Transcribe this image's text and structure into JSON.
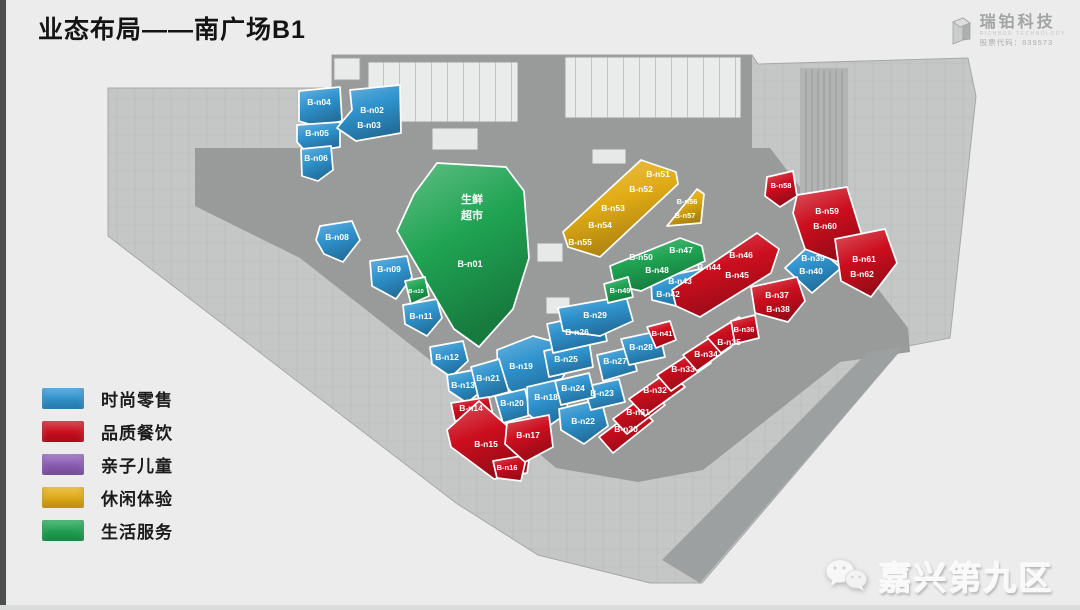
{
  "slide": {
    "title": "业态布局——南广场B1",
    "logo": {
      "name": "瑞铂科技",
      "subtitle": "RICHBOR TECHNOLOGY",
      "stock": "股票代码：839573"
    },
    "watermark": "嘉兴第九区"
  },
  "legend": [
    {
      "key": "retail",
      "label": "时尚零售",
      "color": "#2F93CE"
    },
    {
      "key": "dining",
      "label": "品质餐饮",
      "color": "#CC0E1E"
    },
    {
      "key": "kids",
      "label": "亲子儿童",
      "color": "#8B5CB6"
    },
    {
      "key": "leisure",
      "label": "休闲体验",
      "color": "#E2AC15"
    },
    {
      "key": "life",
      "label": "生活服务",
      "color": "#1FA352"
    }
  ],
  "floorplan": {
    "category_colors": {
      "retail": "#2F93CE",
      "dining": "#CC0E1E",
      "kids": "#8B5CB6",
      "leisure": "#E2AC15",
      "life": "#1FA352"
    },
    "units": [
      {
        "id": "B-n04",
        "category": "retail",
        "points": "299,91 340,87 342,121 318,127 299,121",
        "labels": [
          {
            "t": "B-n04",
            "x": 319,
            "y": 105
          }
        ]
      },
      {
        "id": "B-n05",
        "category": "retail",
        "points": "297,125 340,122 340,147 306,152 297,142",
        "labels": [
          {
            "t": "B-n05",
            "x": 317,
            "y": 136
          }
        ]
      },
      {
        "id": "B-n02-03",
        "category": "retail",
        "points": "350,90 400,85 401,133 356,141 337,128 352,110",
        "labels": [
          {
            "t": "B-n02",
            "x": 372,
            "y": 113
          },
          {
            "t": "B-n03",
            "x": 369,
            "y": 128
          }
        ]
      },
      {
        "id": "B-n06",
        "category": "retail",
        "points": "301,149 331,146 333,170 318,181 302,176",
        "labels": [
          {
            "t": "B-n06",
            "x": 316,
            "y": 161
          }
        ]
      },
      {
        "id": "B-n08",
        "category": "retail",
        "points": "320,226 352,221 360,240 343,262 324,254 316,240",
        "labels": [
          {
            "t": "B-n08",
            "x": 337,
            "y": 240
          }
        ]
      },
      {
        "id": "B-n09",
        "category": "retail",
        "points": "370,261 407,256 412,277 396,299 372,286",
        "labels": [
          {
            "t": "B-n09",
            "x": 389,
            "y": 272
          }
        ]
      },
      {
        "id": "B-n11",
        "category": "retail",
        "points": "403,305 437,299 442,318 427,336 405,324",
        "labels": [
          {
            "t": "B-n11",
            "x": 421,
            "y": 319
          }
        ]
      },
      {
        "id": "B-n12",
        "category": "retail",
        "points": "430,347 463,341 468,361 451,377 432,364",
        "labels": [
          {
            "t": "B-n12",
            "x": 447,
            "y": 360
          }
        ]
      },
      {
        "id": "B-n13",
        "category": "retail",
        "points": "447,375 479,369 484,389 467,403 449,391",
        "labels": [
          {
            "t": "B-n13",
            "x": 463,
            "y": 388
          }
        ]
      },
      {
        "id": "B-n19",
        "category": "retail",
        "points": "497,350 533,336 562,344 566,372 551,396 519,400 498,378",
        "labels": [
          {
            "t": "B-n19",
            "x": 521,
            "y": 369
          }
        ]
      },
      {
        "id": "B-n21",
        "category": "retail",
        "points": "471,367 499,359 509,392 479,400",
        "labels": [
          {
            "t": "B-n21",
            "x": 488,
            "y": 381
          }
        ]
      },
      {
        "id": "B-n20",
        "category": "retail",
        "points": "495,396 525,389 531,415 503,423",
        "labels": [
          {
            "t": "B-n20",
            "x": 512,
            "y": 406
          }
        ]
      },
      {
        "id": "B-n18",
        "category": "retail",
        "points": "527,387 561,379 569,412 546,428 528,414",
        "labels": [
          {
            "t": "B-n18",
            "x": 546,
            "y": 400
          }
        ]
      },
      {
        "id": "B-n22",
        "category": "retail",
        "points": "559,409 601,399 608,426 584,444 561,430",
        "labels": [
          {
            "t": "B-n22",
            "x": 583,
            "y": 424
          }
        ]
      },
      {
        "id": "B-n23",
        "category": "retail",
        "points": "584,387 619,379 625,402 591,410",
        "labels": [
          {
            "t": "B-n23",
            "x": 602,
            "y": 396
          }
        ]
      },
      {
        "id": "B-n24",
        "category": "retail",
        "points": "555,381 589,373 595,397 561,405",
        "labels": [
          {
            "t": "B-n24",
            "x": 573,
            "y": 391
          }
        ]
      },
      {
        "id": "B-n25",
        "category": "retail",
        "points": "544,351 589,341 593,367 549,377",
        "labels": [
          {
            "t": "B-n25",
            "x": 566,
            "y": 362
          }
        ]
      },
      {
        "id": "B-n26",
        "category": "retail",
        "points": "547,324 601,312 607,341 553,353",
        "labels": [
          {
            "t": "B-n26",
            "x": 577,
            "y": 335
          }
        ]
      },
      {
        "id": "B-n27",
        "category": "retail",
        "points": "597,355 631,347 637,371 603,381",
        "labels": [
          {
            "t": "B-n27",
            "x": 615,
            "y": 364
          }
        ]
      },
      {
        "id": "B-n28",
        "category": "retail",
        "points": "621,339 659,331 665,357 629,365",
        "labels": [
          {
            "t": "B-n28",
            "x": 641,
            "y": 350
          }
        ]
      },
      {
        "id": "B-n29",
        "category": "retail",
        "points": "558,308 626,296 633,321 600,336 563,331",
        "labels": [
          {
            "t": "B-n29",
            "x": 595,
            "y": 318
          }
        ]
      },
      {
        "id": "B-n42-43",
        "category": "retail",
        "points": "651,279 701,269 707,291 688,309 652,300",
        "labels": [
          {
            "t": "B-n43",
            "x": 680,
            "y": 284
          },
          {
            "t": "B-n42",
            "x": 668,
            "y": 297
          }
        ]
      },
      {
        "id": "B-n39-40",
        "category": "retail",
        "points": "812,243 841,268 812,293 785,268",
        "labels": [
          {
            "t": "B-n39",
            "x": 813,
            "y": 261
          },
          {
            "t": "B-n40",
            "x": 811,
            "y": 274
          }
        ]
      },
      {
        "id": "B-n14",
        "category": "dining",
        "points": "451,403 489,397 493,415 455,421",
        "labels": [
          {
            "t": "B-n14",
            "x": 471,
            "y": 411
          }
        ]
      },
      {
        "id": "B-n15",
        "category": "dining",
        "points": "447,430 479,401 531,447 527,473 494,479 451,447",
        "labels": [
          {
            "t": "B-n15",
            "x": 486,
            "y": 447
          }
        ]
      },
      {
        "id": "B-n16",
        "category": "dining",
        "points": "493,461 527,455 521,481 497,478",
        "labels": [
          {
            "t": "B-n16",
            "x": 507,
            "y": 470,
            "s": 7.5
          }
        ]
      },
      {
        "id": "B-n17",
        "category": "dining",
        "points": "507,423 549,415 553,447 525,462 505,444",
        "labels": [
          {
            "t": "B-n17",
            "x": 528,
            "y": 438
          }
        ]
      },
      {
        "id": "B-n41",
        "category": "dining",
        "points": "647,327 670,321 676,340 656,348",
        "labels": [
          {
            "t": "B-n41",
            "x": 662,
            "y": 336,
            "s": 7.5
          }
        ]
      },
      {
        "id": "B-n30",
        "category": "dining",
        "points": "599,437 639,407 653,421 613,453",
        "labels": [
          {
            "t": "B-n30",
            "x": 626,
            "y": 432
          }
        ]
      },
      {
        "id": "B-n31",
        "category": "dining",
        "points": "613,419 651,391 665,405 627,434",
        "labels": [
          {
            "t": "B-n31",
            "x": 638,
            "y": 415
          }
        ]
      },
      {
        "id": "B-n32",
        "category": "dining",
        "points": "629,399 669,371 685,387 645,416",
        "labels": [
          {
            "t": "B-n32",
            "x": 655,
            "y": 393
          }
        ]
      },
      {
        "id": "B-n33",
        "category": "dining",
        "points": "657,375 697,349 711,363 671,391",
        "labels": [
          {
            "t": "B-n33",
            "x": 683,
            "y": 372
          }
        ]
      },
      {
        "id": "B-n34",
        "category": "dining",
        "points": "683,355 717,333 731,347 697,371",
        "labels": [
          {
            "t": "B-n34",
            "x": 706,
            "y": 357
          }
        ]
      },
      {
        "id": "B-n35",
        "category": "dining",
        "points": "707,337 739,317 753,331 721,353",
        "labels": [
          {
            "t": "B-n35",
            "x": 729,
            "y": 345
          }
        ]
      },
      {
        "id": "B-n36",
        "category": "dining",
        "points": "731,321 755,315 759,338 735,344",
        "labels": [
          {
            "t": "B-n36",
            "x": 744,
            "y": 332,
            "s": 7.5
          }
        ]
      },
      {
        "id": "B-n37-38",
        "category": "dining",
        "points": "751,287 797,277 805,301 788,322 755,313",
        "labels": [
          {
            "t": "B-n37",
            "x": 777,
            "y": 298
          },
          {
            "t": "B-n38",
            "x": 778,
            "y": 312
          }
        ]
      },
      {
        "id": "B-n44-46",
        "category": "dining",
        "points": "672,290 757,233 779,249 771,273 700,317 676,306",
        "labels": [
          {
            "t": "B-n46",
            "x": 741,
            "y": 258
          },
          {
            "t": "B-n45",
            "x": 737,
            "y": 278
          },
          {
            "t": "B-n44",
            "x": 709,
            "y": 270
          }
        ]
      },
      {
        "id": "B-n58",
        "category": "dining",
        "points": "767,177 793,171 797,196 780,207 765,196",
        "labels": [
          {
            "t": "B-n58",
            "x": 781,
            "y": 188,
            "s": 7.5
          }
        ]
      },
      {
        "id": "B-n59-60",
        "category": "dining",
        "points": "797,195 847,187 863,239 841,263 805,249 793,213",
        "labels": [
          {
            "t": "B-n59",
            "x": 827,
            "y": 214
          },
          {
            "t": "B-n60",
            "x": 825,
            "y": 229
          }
        ]
      },
      {
        "id": "B-n61-62",
        "category": "dining",
        "points": "835,239 885,229 897,263 871,297 841,281",
        "labels": [
          {
            "t": "B-n61",
            "x": 864,
            "y": 262
          },
          {
            "t": "B-n62",
            "x": 862,
            "y": 277
          }
        ]
      },
      {
        "id": "B-n01",
        "category": "life",
        "points": "437,163 506,167 524,191 529,258 513,309 479,347 454,329 407,249 397,231 414,194",
        "labels": [
          {
            "t": "生鲜",
            "x": 472,
            "y": 203,
            "s": 11
          },
          {
            "t": "超市",
            "x": 472,
            "y": 219,
            "s": 11
          },
          {
            "t": "B-n01",
            "x": 470,
            "y": 267,
            "s": 9
          }
        ]
      },
      {
        "id": "B-n10",
        "category": "life",
        "points": "405,281 425,277 429,296 411,304",
        "labels": [
          {
            "t": "B-n10",
            "x": 416,
            "y": 293,
            "s": 5.5
          }
        ]
      },
      {
        "id": "B-n47-50",
        "category": "life",
        "points": "610,266 680,238 702,246 705,261 641,291 614,285",
        "labels": [
          {
            "t": "B-n50",
            "x": 641,
            "y": 260
          },
          {
            "t": "B-n47",
            "x": 681,
            "y": 253
          },
          {
            "t": "B-n48",
            "x": 657,
            "y": 273
          }
        ]
      },
      {
        "id": "B-n49",
        "category": "life",
        "points": "604,284 628,277 633,297 608,303",
        "labels": [
          {
            "t": "B-n49",
            "x": 620,
            "y": 293,
            "s": 7.5
          }
        ]
      },
      {
        "id": "B-n51-55",
        "category": "leisure",
        "points": "641,160 676,172 678,184 600,257 568,247 563,232",
        "labels": [
          {
            "t": "B-n51",
            "x": 658,
            "y": 177
          },
          {
            "t": "B-n52",
            "x": 641,
            "y": 192
          },
          {
            "t": "B-n53",
            "x": 613,
            "y": 211
          },
          {
            "t": "B-n54",
            "x": 600,
            "y": 228
          },
          {
            "t": "B-n55",
            "x": 580,
            "y": 245
          }
        ]
      },
      {
        "id": "B-n56-57",
        "category": "leisure",
        "points": "697,189 704,194 701,223 667,226",
        "labels": [
          {
            "t": "B-n56",
            "x": 687,
            "y": 204,
            "s": 7.5
          },
          {
            "t": "B-n57",
            "x": 685,
            "y": 218,
            "s": 7.5
          }
        ]
      }
    ]
  }
}
